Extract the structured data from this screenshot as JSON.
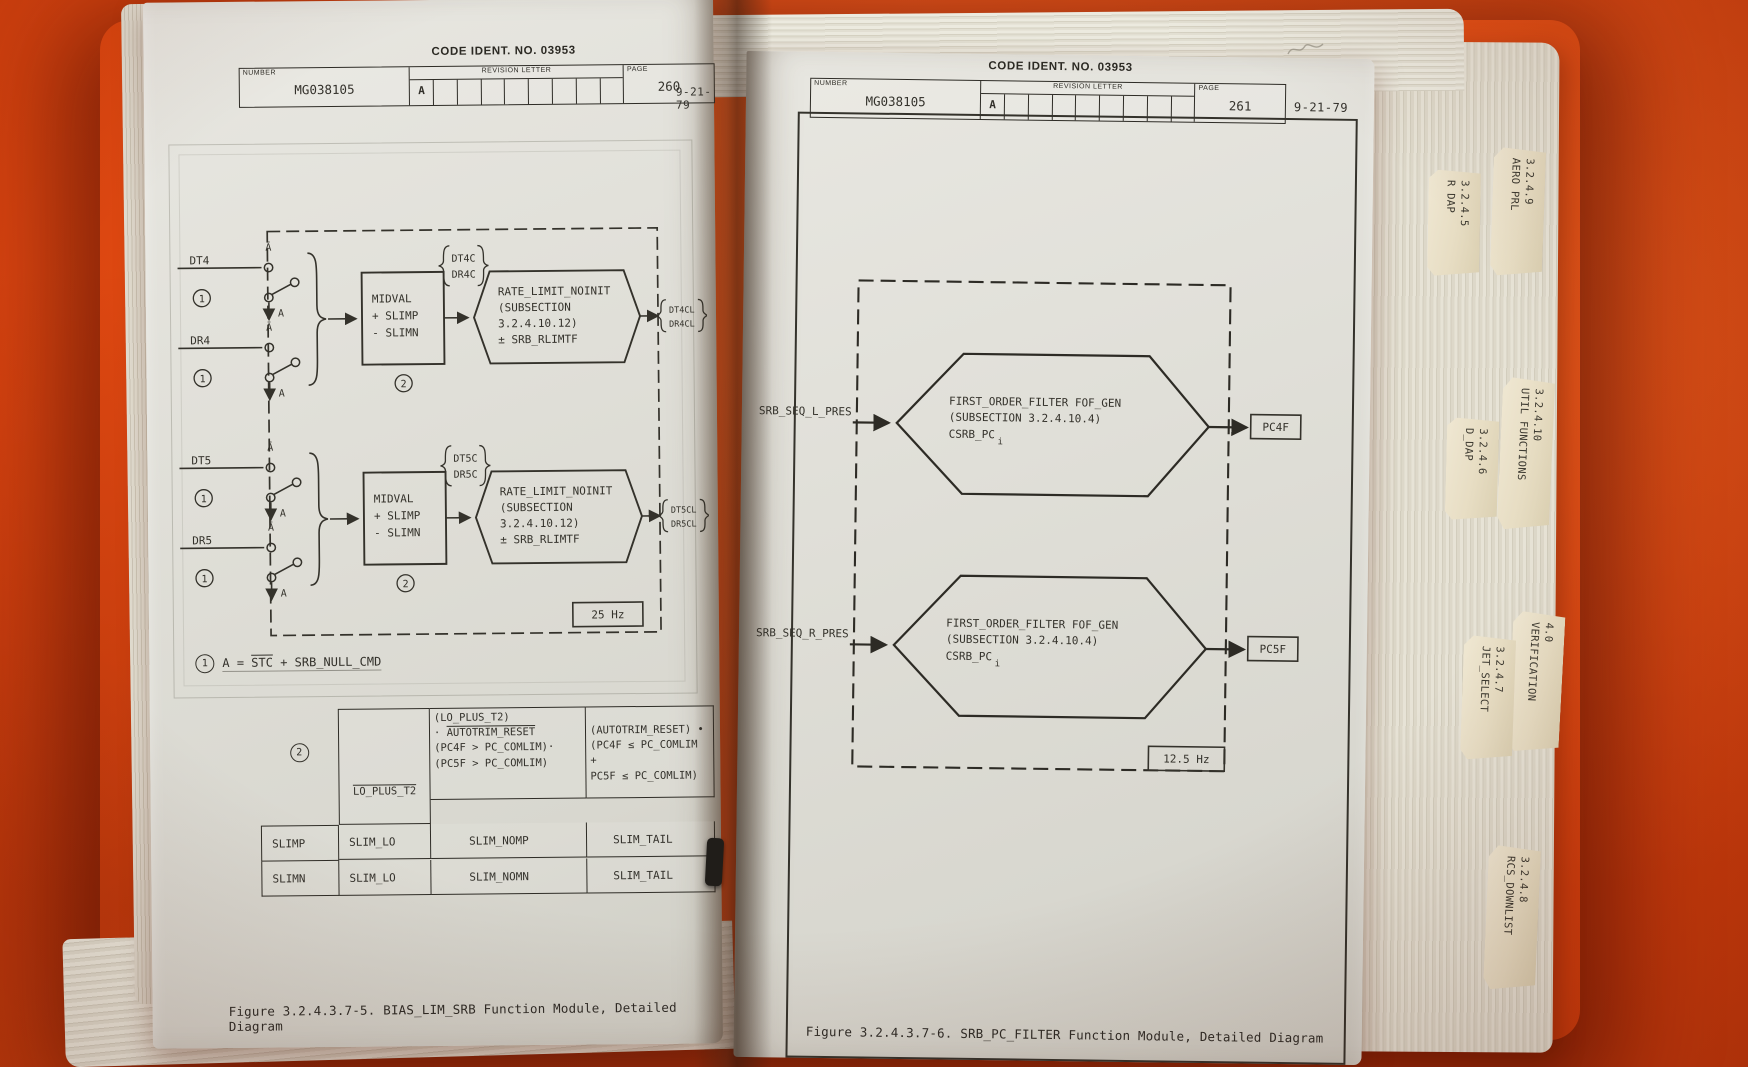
{
  "colors": {
    "backdrop": "#e24c13",
    "page": "#e1e0d8",
    "ink": "#33312b",
    "tab_paper": "#ece3cd"
  },
  "left_page": {
    "code_ident": "CODE IDENT. NO. 03953",
    "title_block": {
      "number_label": "NUMBER",
      "number_value": "MG038105",
      "revision_label": "REVISION LETTER",
      "revision_value": "A",
      "page_label": "PAGE",
      "page_value": "260"
    },
    "date": "9-21-79",
    "diagram": {
      "channels": [
        {
          "input_top": "DT4",
          "input_bottom": "DR4",
          "abar": "Ā",
          "a_label": "A",
          "switch_note": "1",
          "mid_lines": [
            "MIDVAL",
            "+ SLIMP",
            "- SLIMN"
          ],
          "mid_note": "2",
          "pre_labels": [
            "DT4C",
            "DR4C"
          ],
          "hex_lines": [
            "RATE_LIMIT_NOINIT",
            "(SUBSECTION",
            "3.2.4.10.12)",
            "± SRB_RLIMTF"
          ],
          "out_labels": [
            "DT4CL",
            "DR4CL"
          ]
        },
        {
          "input_top": "DT5",
          "input_bottom": "DR5",
          "abar": "Ā",
          "a_label": "A",
          "switch_note": "1",
          "mid_lines": [
            "MIDVAL",
            "+ SLIMP",
            "- SLIMN"
          ],
          "mid_note": "2",
          "pre_labels": [
            "DT5C",
            "DR5C"
          ],
          "hex_lines": [
            "RATE_LIMIT_NOINIT",
            "(SUBSECTION",
            "3.2.4.10.12)",
            "± SRB_RLIMTF"
          ],
          "out_labels": [
            "DT5CL",
            "DR5CL"
          ]
        }
      ],
      "rate_badge": "25 Hz",
      "note": {
        "marker": "1",
        "prefix": "A = ",
        "negated": "STC",
        "suffix": " + SRB_NULL_CMD"
      }
    },
    "table": {
      "marker": "2",
      "header_negated": "LO_PLUS_T2",
      "header_mid": {
        "line1": "(LO_PLUS_T2)",
        "line2_dot": "· ",
        "line2_negated": "AUTOTRIM_RESET",
        "line3": "(PC4F > PC_COMLIM)·",
        "line4": "(PC5F > PC_COMLIM)"
      },
      "header_right": {
        "line1": "(AUTOTRIM_RESET) •",
        "line2": "(PC4F ≤ PC_COMLIM +",
        "line3": "PC5F ≤ PC_COMLIM)"
      },
      "rows": [
        {
          "name": "SLIMP",
          "c1": "SLIM_LO",
          "c2": "SLIM_NOMP",
          "c3": "SLIM_TAIL"
        },
        {
          "name": "SLIMN",
          "c1": "SLIM_LO",
          "c2": "SLIM_NOMN",
          "c3": "SLIM_TAIL"
        }
      ]
    },
    "caption": "Figure 3.2.4.3.7-5.  BIAS_LIM_SRB Function Module, Detailed Diagram"
  },
  "right_page": {
    "code_ident": "CODE IDENT. NO. 03953",
    "title_block": {
      "number_label": "NUMBER",
      "number_value": "MG038105",
      "revision_label": "REVISION LETTER",
      "revision_value": "A",
      "page_label": "PAGE",
      "page_value": "261"
    },
    "date": "9-21-79",
    "diagram": {
      "filters": [
        {
          "input": "SRB_SEQ_L_PRES",
          "hex_lines": [
            "FIRST_ORDER_FILTER FOF_GEN",
            "(SUBSECTION 3.2.4.10.4)",
            "CSRB_PC"
          ],
          "hex_subscript": "i",
          "output": "PC4F"
        },
        {
          "input": "SRB_SEQ_R_PRES",
          "hex_lines": [
            "FIRST_ORDER_FILTER FOF_GEN",
            "(SUBSECTION 3.2.4.10.4)",
            "CSRB_PC"
          ],
          "hex_subscript": "i",
          "output": "PC5F"
        }
      ],
      "rate_badge": "12.5 Hz"
    },
    "caption": "Figure 3.2.4.3.7-6.  SRB_PC_FILTER Function Module, Detailed Diagram"
  },
  "tabs": [
    {
      "section": "3.2.4.9",
      "label": "AERO PRL"
    },
    {
      "section": "3.2.4.5",
      "label": "R DAP"
    },
    {
      "section": "3.2.4.10",
      "label": "UTIL FUNCTIONS"
    },
    {
      "section": "3.2.4.6",
      "label": "D_DAP"
    },
    {
      "section": "4.0",
      "label": "VERIFICATION"
    },
    {
      "section": "3.2.4.7",
      "label": "JET_SELECT"
    },
    {
      "section": "3.2.4.8",
      "label": "RCS_DOWNLIST"
    }
  ]
}
